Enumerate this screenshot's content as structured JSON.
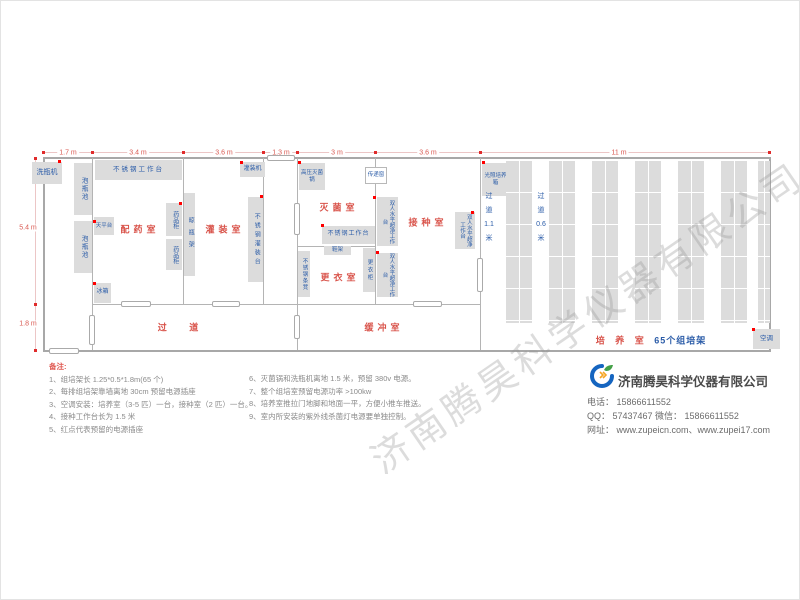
{
  "plan": {
    "dims_top": [
      "1.7 m",
      "3.4 m",
      "3.6 m",
      "1.3 m",
      "3 m",
      "3.6 m",
      "11 m"
    ],
    "dims_left": [
      "5.4 m",
      "1.8 m"
    ],
    "rooms": {
      "prep": "配药室",
      "filling": "灌装室",
      "sterilization": "灭菌室",
      "changing": "更衣室",
      "inoculation": "接种室",
      "corridor": "过  道",
      "buffer": "缓冲室",
      "culture": "培 养 室",
      "culture_sub": "65个组培架"
    },
    "aisles": {
      "a1": [
        "过",
        "道",
        "1.1",
        "米"
      ],
      "a2": [
        "过",
        "道",
        "0.6",
        "米"
      ]
    },
    "equipment": {
      "washer": "洗瓶机",
      "soak_pool": "泡瓶池",
      "ss_worktable": "不锈钢工作台",
      "balance": "天平台",
      "fridge": "冰箱",
      "cabinet": "药品柜",
      "bottle_rack": "晾瓶架",
      "filler": "灌装机",
      "filling_table": "不锈钢灌装台",
      "autoclave": "高压灭菌锅",
      "pass_window": "传递窗",
      "shoe_rack": "鞋架",
      "ss_bench": "不锈钢条凳",
      "locker": "更衣柜",
      "clean_bench": "双人水平超净工作台",
      "incubator": "光照培养箱",
      "ac": "空调"
    }
  },
  "notes": {
    "heading": "备注:",
    "left": [
      "1、组培架长 1.25*0.5*1.8m(65 个)",
      "2、每排组培架靠墙离地 30cm 预留电源插座",
      "3、空调安装：培养室（3-5 匹）一台，接种室（2 匹）一台。",
      "4、接种工作台长为 1.5 米",
      "5、红点代表预留的电源插座"
    ],
    "right": [
      "6、灭菌锅和洗瓶机离地 1.5 米，预留 380v 电源。",
      "7、整个组培室预留电源功率 >100kw",
      "8、培养室推拉门地脚和地面一平，方便小推车推送。",
      "9、室内所安装的紫外线杀菌灯电源要单独控制。"
    ]
  },
  "company": {
    "name": "济南腾昊科学仪器有限公司",
    "lines": [
      "电话： 15866611552",
      "QQ： 57437467   微信： 15866611552",
      "网址： www.zupeicn.com、www.zupei17.com"
    ]
  },
  "watermark": "济南腾昊科学仪器有限公司"
}
